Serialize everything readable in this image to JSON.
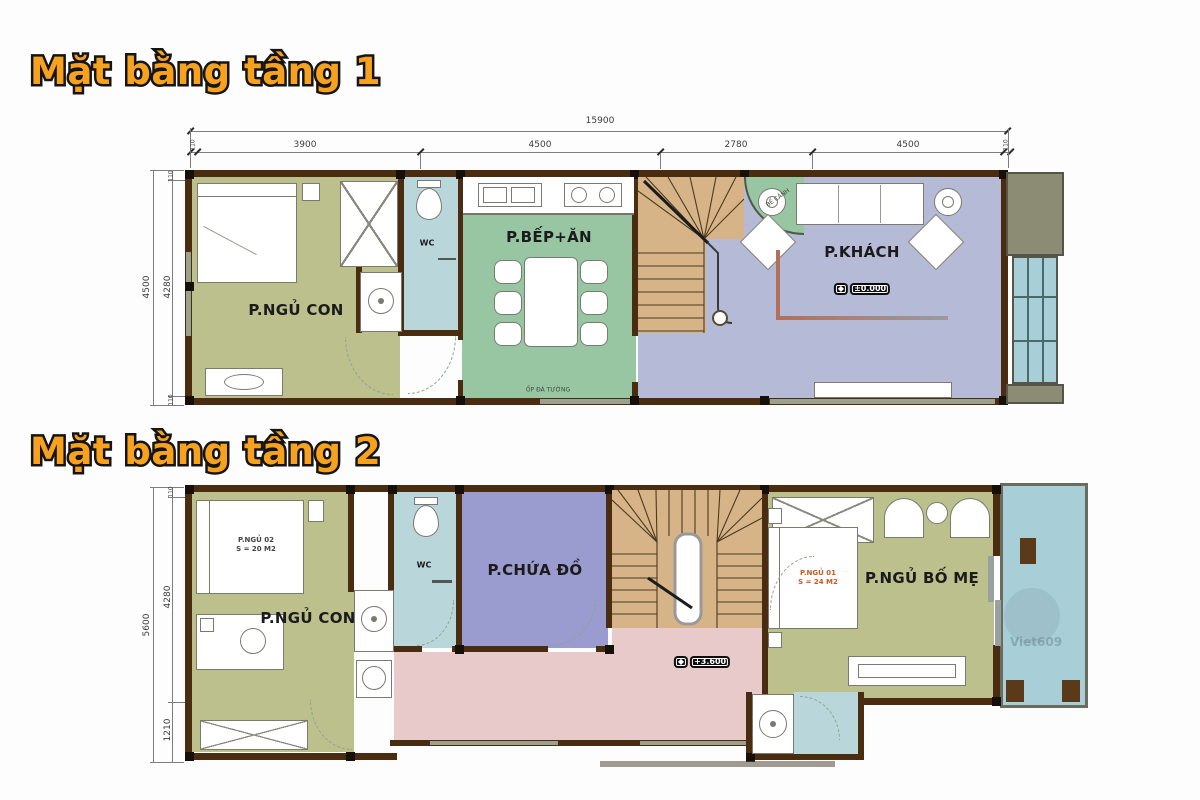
{
  "watermark": "Viet609",
  "colors": {
    "title_orange": "#F6A21E",
    "bedroom_olive": "#BCC08D",
    "kitchen_green": "#98C6A2",
    "living_lavender": "#B5BBD7",
    "storage_purple": "#9A9BCE",
    "wc_blue": "#B9D6DA",
    "balcony_teal": "#A8CED8",
    "hall_pink": "#E9CACA",
    "stair_tan": "#D7B488",
    "wall_brown": "#4A2C10"
  },
  "plan1": {
    "title": "Mặt bằng tầng 1",
    "dims": {
      "top_total": "15900",
      "top_segments": [
        "110",
        "3900",
        "4500",
        "2780",
        "4500",
        "110"
      ],
      "left_total": "4500",
      "left_segments": [
        "110",
        "4280",
        "110"
      ]
    },
    "rooms": {
      "bedroom": "P.NGỦ CON",
      "wc": "WC",
      "kitchen": "P.BẾP+ĂN",
      "living": "P.KHÁCH"
    },
    "elevation": "±0.000",
    "notes": {
      "kitchen_wall": "ỐP ĐÁ TƯỜNG",
      "stair_garden": "BỂ CẢNH"
    }
  },
  "plan2": {
    "title": "Mặt bằng tầng 2",
    "dims": {
      "left_total": "5600",
      "left_segments": [
        "110",
        "4280",
        "1210"
      ]
    },
    "rooms": {
      "bedroom": "P.NGỦ CON",
      "wc": "WC",
      "storage": "P.CHỨA ĐỒ",
      "master": "P.NGỦ BỐ MẸ"
    },
    "bed_tags": {
      "bed2_name": "P.NGỦ 02",
      "bed2_area": "S = 20 M2",
      "bed1_name": "P.NGỦ 01",
      "bed1_area": "S = 24 M2"
    },
    "elevation": "+3.600"
  }
}
